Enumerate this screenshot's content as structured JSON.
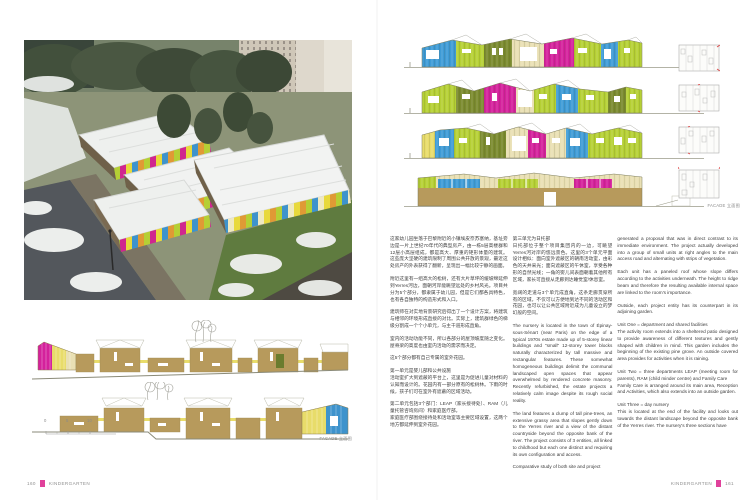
{
  "palette": {
    "accent_pink": "#e0419b",
    "lime": "#b5d034",
    "olive": "#7a8a2e",
    "magenta": "#d4219c",
    "blue": "#3e9bd6",
    "cream": "#e9e0b4",
    "tan": "#b79a5c"
  },
  "left_page": {
    "page_number": "160",
    "footer_label": "KINDERGARTEN",
    "drawings": {
      "facade_label": "FACADE 立面图",
      "scale_ticks": [
        "0",
        "5",
        "10"
      ]
    }
  },
  "right_page": {
    "page_number": "161",
    "footer_label": "KINDERGARTEN",
    "drawings": {
      "facade_label": "FACADE 立面图"
    },
    "text_columns": {
      "col1": {
        "paragraphs": [
          "这家幼儿园坐落于巴黎附近的小镇埃皮奈苏塞纳，基址旁边是一片上世纪70年代的典型房产，由一栋5层高楼群和12层小高层组成，都是高大、厚重的矩形体量的建筑。这些庞大坚硬的建筑限制了周围公共开放的景观，最近这处房产的外表获得了翻新，呈现出一幅比较宁静的画面。",
          "附近这里有一组高大的松树，还有大片草坪的缓坡绵延伸到Yerres河边，面朝河岸能眺望远处的乡村风光。项目共分为5个部分，都隶属于幼儿园，但是它们都各具特色，也有各自独特的构造形式和入口。",
          "建筑师在对实地背景研究后得出了一个设计方案，将建筑与相邻的环境形成直接的对比。实际上，建筑群绿色的梯级分割成一个个小单元，与主干道形成直角。",
          "室内的活动功能不同，所以各部分的屋顶坡度随之变化。屋脊梁的高度也由室内活动的需求而决定。",
          "这5个部分都有自己专属的室外花园。",
          "第一单元是婴儿部和公共设施\n活动室扩大到遮蔽的平台上，这里是为促进儿童对材料的认知而设计的。花园内有一部分原有的松树林。下雨的时候，孩子们可在室外有遮蔽的区域活动。",
          "第二单元包括3个部门：LEAP（家长接待处）、RAM（儿童托管咨询房间）和家庭医疗部。\n家庭医疗部围绕接待处和活动室等主要区域设置，这两个地方都延伸到室外花园。"
        ]
      },
      "col2": {
        "paragraphs": [
          "第三单元为日托部\n日托部位于整个项目集团内的一边，可眺望Yerres河对岸的悠远景色。这里的3个单元平面设计相似：面向室外遮蔽区的朝南活动室，由彩色的天井采光；面向遮蔽区的午休室，享受各种形的自然光线；一角的婴儿间表面朝着其他所有区域，家长可直接从走廊到达睡觉室/休息室。",
          "宽阔的走道与3个单元成直角，这条走廊贯穿所有的区域，不仅可以方便地到达不同的活动区和花园，也可以让公共区域附近成为儿童设立的梦幻般的空间。",
          "The nursery is located in the town of Épinay-sous-Sénart (near Paris) on the edge of a typical 1970s estate made up of 5-storey linear buildings and \"small\" 12-storey tower blocks naturally characterized by tall massive and rectangular features. These somewhat homogeneous buildings delimit the communal landscaped open spaces that appear overwhelmed by rendered concrete masonry. Recently refurbished, the estate projects a relatively calm image despite its rough social reality.",
          "The land features a clump of tall pine-trees, an extensive grassy area that slopes gently down to the Yerres river and a view of the distant countryside beyond the opposite bank of the river. The project consists of 3 entities, all linked to childhood but each one distinct and requiring its own configuration and access.",
          "Comparative study of both site and project"
        ]
      },
      "col3": {
        "paragraphs": [
          "generated a proposal that was in direct contrast to its immediate environment. The project actually developed into a group of small units at right angles to the main access road and alternating with strips of vegetation.",
          "Each unit has a paneled roof whose slope differs according to the activities underneath. The height to ridge beam and therefore the resulting available internal space are linked to the room's importance.",
          "Outside, each project entity has its counterpart in its adjoining garden.",
          "Unit One = department and shared facilities\nThe activity room extends into a sheltered patio designed to provide awareness of different textures and gently shaped with children in mind. This garden includes the beginning of the existing pine grove. An outside covered area provides for activities when it is raining.",
          "Unit Two = three departments LEAP (meeting room for parents), RAM (child minder centre) and Family Care\nFamily Care is arranged around its main area, Reception and Activities, which also extends into an outside garden.",
          "Unit Three = day nursery\nThis is located at the end of the facility and looks out towards the distant landscape beyond the opposite bank of the Yerres river. The nursery's three sections have"
        ]
      }
    }
  }
}
